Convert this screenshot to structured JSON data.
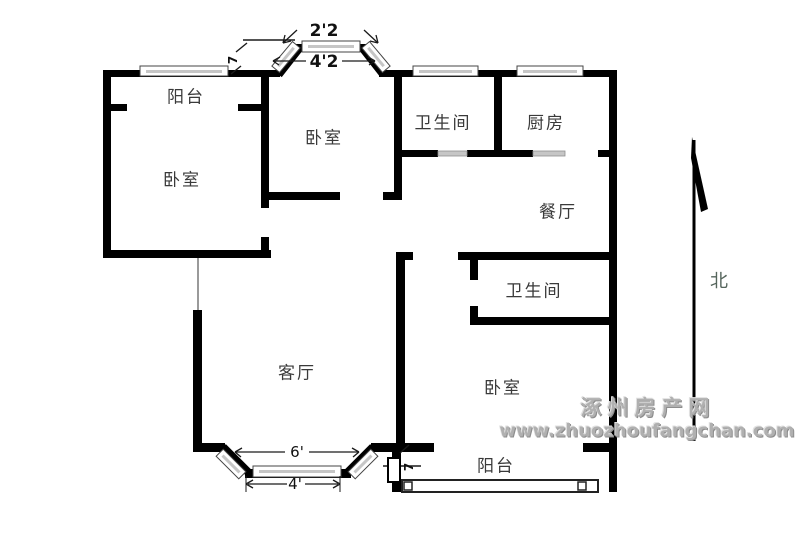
{
  "floorplan": {
    "rooms": [
      {
        "id": "balcony-top",
        "label": "阳台"
      },
      {
        "id": "bedroom-left",
        "label": "卧室"
      },
      {
        "id": "bedroom-top",
        "label": "卧室"
      },
      {
        "id": "bathroom-top",
        "label": "卫生间"
      },
      {
        "id": "kitchen",
        "label": "厨房"
      },
      {
        "id": "dining",
        "label": "餐厅"
      },
      {
        "id": "bathroom-mid",
        "label": "卫生间"
      },
      {
        "id": "living",
        "label": "客厅"
      },
      {
        "id": "bedroom-right",
        "label": "卧室"
      },
      {
        "id": "balcony-bottom",
        "label": "阳台"
      }
    ],
    "dimensions": {
      "bay_top_width_outer": "2'2",
      "bay_top_width_inner": "4'2",
      "bay_bottom_width_outer": "6'",
      "bay_bottom_width_inner": "4'",
      "door_top": "7",
      "door_bottom": "7"
    },
    "compass": {
      "north_label": "北"
    },
    "watermark": {
      "site_name": "涿州房产网",
      "site_url": "www.zhuozhoufangchan.com"
    },
    "colors": {
      "wall": "#000000",
      "window_sill": "#c6c6c6",
      "door_sill": "#c6c6c6",
      "room_label": "#3a3a3a",
      "north_label": "#55655c",
      "watermark": "#b0b0b0",
      "background": "#ffffff"
    }
  }
}
